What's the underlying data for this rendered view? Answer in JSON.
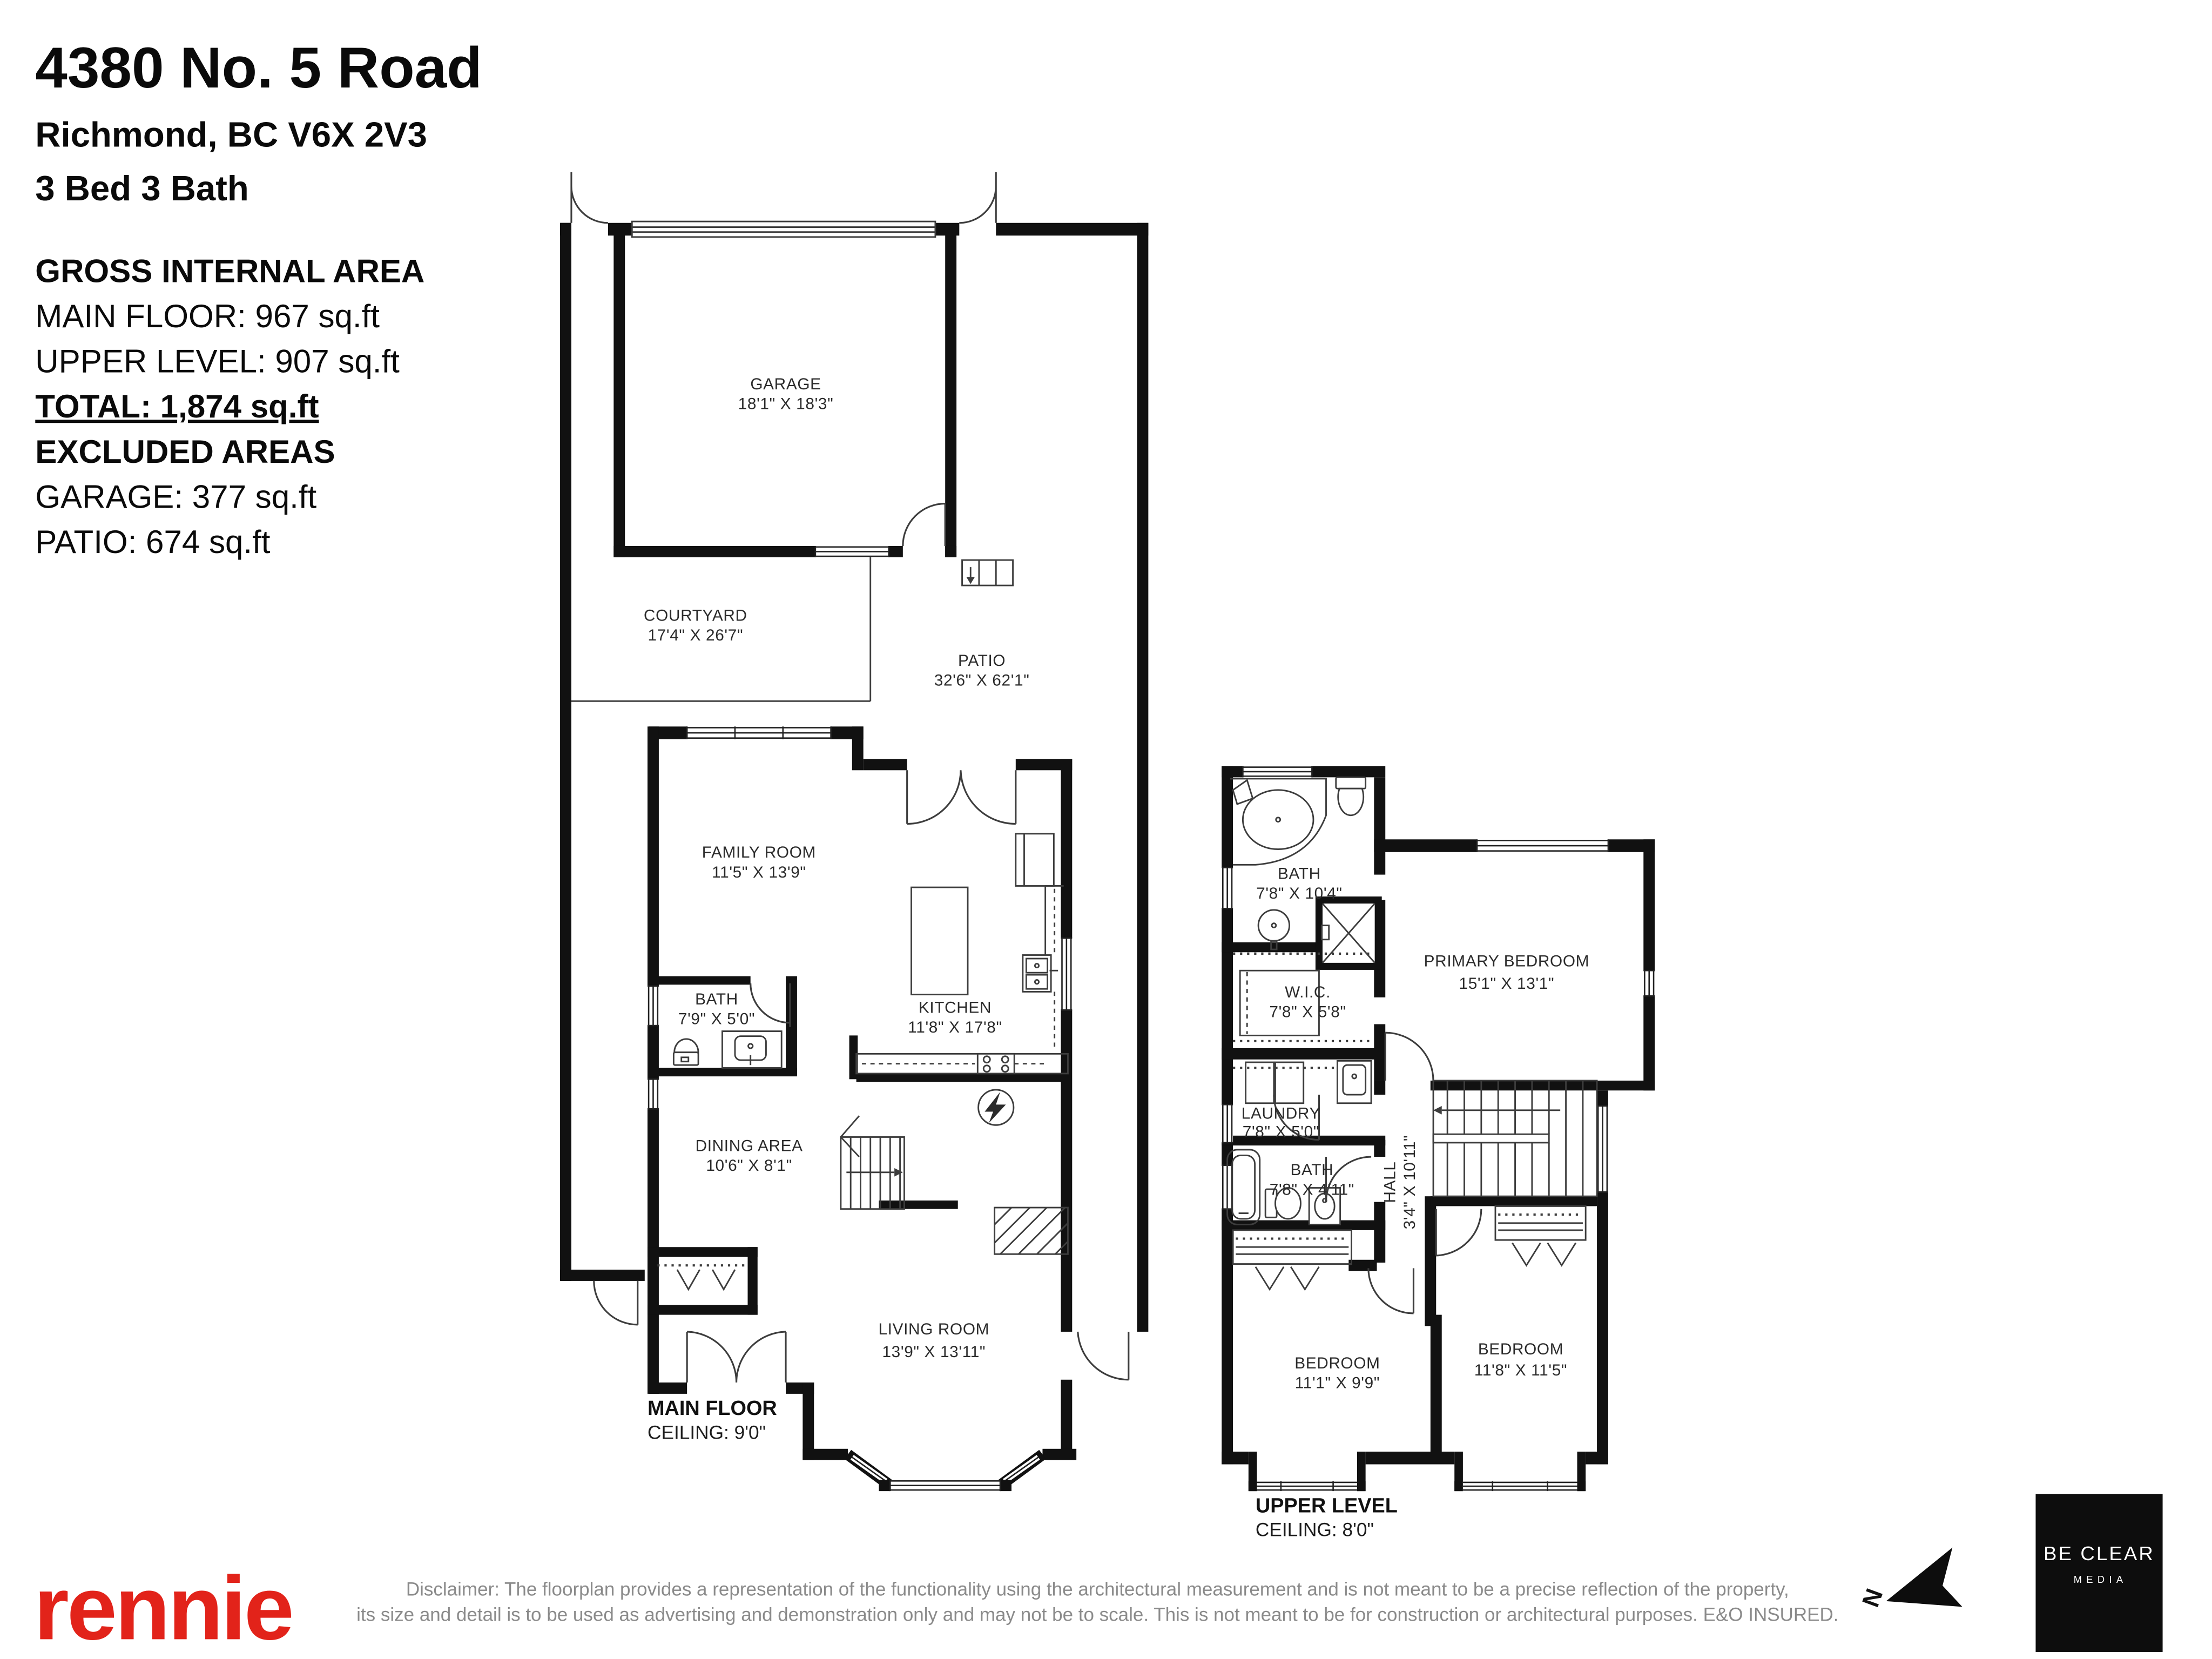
{
  "header": {
    "address": "4380 No. 5 Road",
    "city": "Richmond, BC V6X 2V3",
    "beds_baths": "3 Bed 3 Bath"
  },
  "areas": {
    "gross_title": "GROSS INTERNAL AREA",
    "main_floor": "MAIN FLOOR: 967 sq.ft",
    "upper_level": "UPPER LEVEL: 907 sq.ft",
    "total": "TOTAL: 1,874 sq.ft",
    "excluded_title": "EXCLUDED AREAS",
    "garage": "GARAGE: 377 sq.ft",
    "patio": "PATIO: 674 sq.ft"
  },
  "main_floor": {
    "label": "MAIN FLOOR",
    "ceiling": "CEILING: 9'0\"",
    "rooms": {
      "garage": {
        "name": "GARAGE",
        "dims": "18'1\" X 18'3\""
      },
      "courtyard": {
        "name": "COURTYARD",
        "dims": "17'4\" X 26'7\""
      },
      "patio": {
        "name": "PATIO",
        "dims": "32'6\" X 62'1\""
      },
      "family": {
        "name": "FAMILY ROOM",
        "dims": "11'5\" X 13'9\""
      },
      "bath": {
        "name": "BATH",
        "dims": "7'9\" X 5'0\""
      },
      "kitchen": {
        "name": "KITCHEN",
        "dims": "11'8\" X 17'8\""
      },
      "dining": {
        "name": "DINING AREA",
        "dims": "10'6\" X 8'1\""
      },
      "living": {
        "name": "LIVING ROOM",
        "dims": "13'9\" X 13'11\""
      }
    }
  },
  "upper_level": {
    "label": "UPPER LEVEL",
    "ceiling": "CEILING: 8'0\"",
    "rooms": {
      "bath": {
        "name": "BATH",
        "dims": "7'8\" X 10'4\""
      },
      "wic": {
        "name": "W.I.C.",
        "dims": "7'8\" X 5'8\""
      },
      "primary": {
        "name": "PRIMARY BEDROOM",
        "dims": "15'1\" X 13'1\""
      },
      "laundry": {
        "name": "LAUNDRY",
        "dims": "7'8\" X 5'0\""
      },
      "bath2": {
        "name": "BATH",
        "dims": "7'8\" X 4'11\""
      },
      "hall": {
        "name": "HALL",
        "dims": "3'4\" X 10'11\""
      },
      "bedroom1": {
        "name": "BEDROOM",
        "dims": "11'1\" X 9'9\""
      },
      "bedroom2": {
        "name": "BEDROOM",
        "dims": "11'8\" X 11'5\""
      }
    }
  },
  "footer": {
    "brand": "rennie",
    "disclaimer_line1": "Disclaimer: The floorplan provides a representation of the functionality using the architectural measurement and is not meant to be a precise reflection of the property,",
    "disclaimer_line2": "its size and detail is to be used as advertising and demonstration only and may not be to scale. This is not meant to be for construction or architectural purposes. E&O INSURED.",
    "north_label": "N",
    "media_logo_line1": "BE CLEAR",
    "media_logo_line2": "MEDIA"
  }
}
